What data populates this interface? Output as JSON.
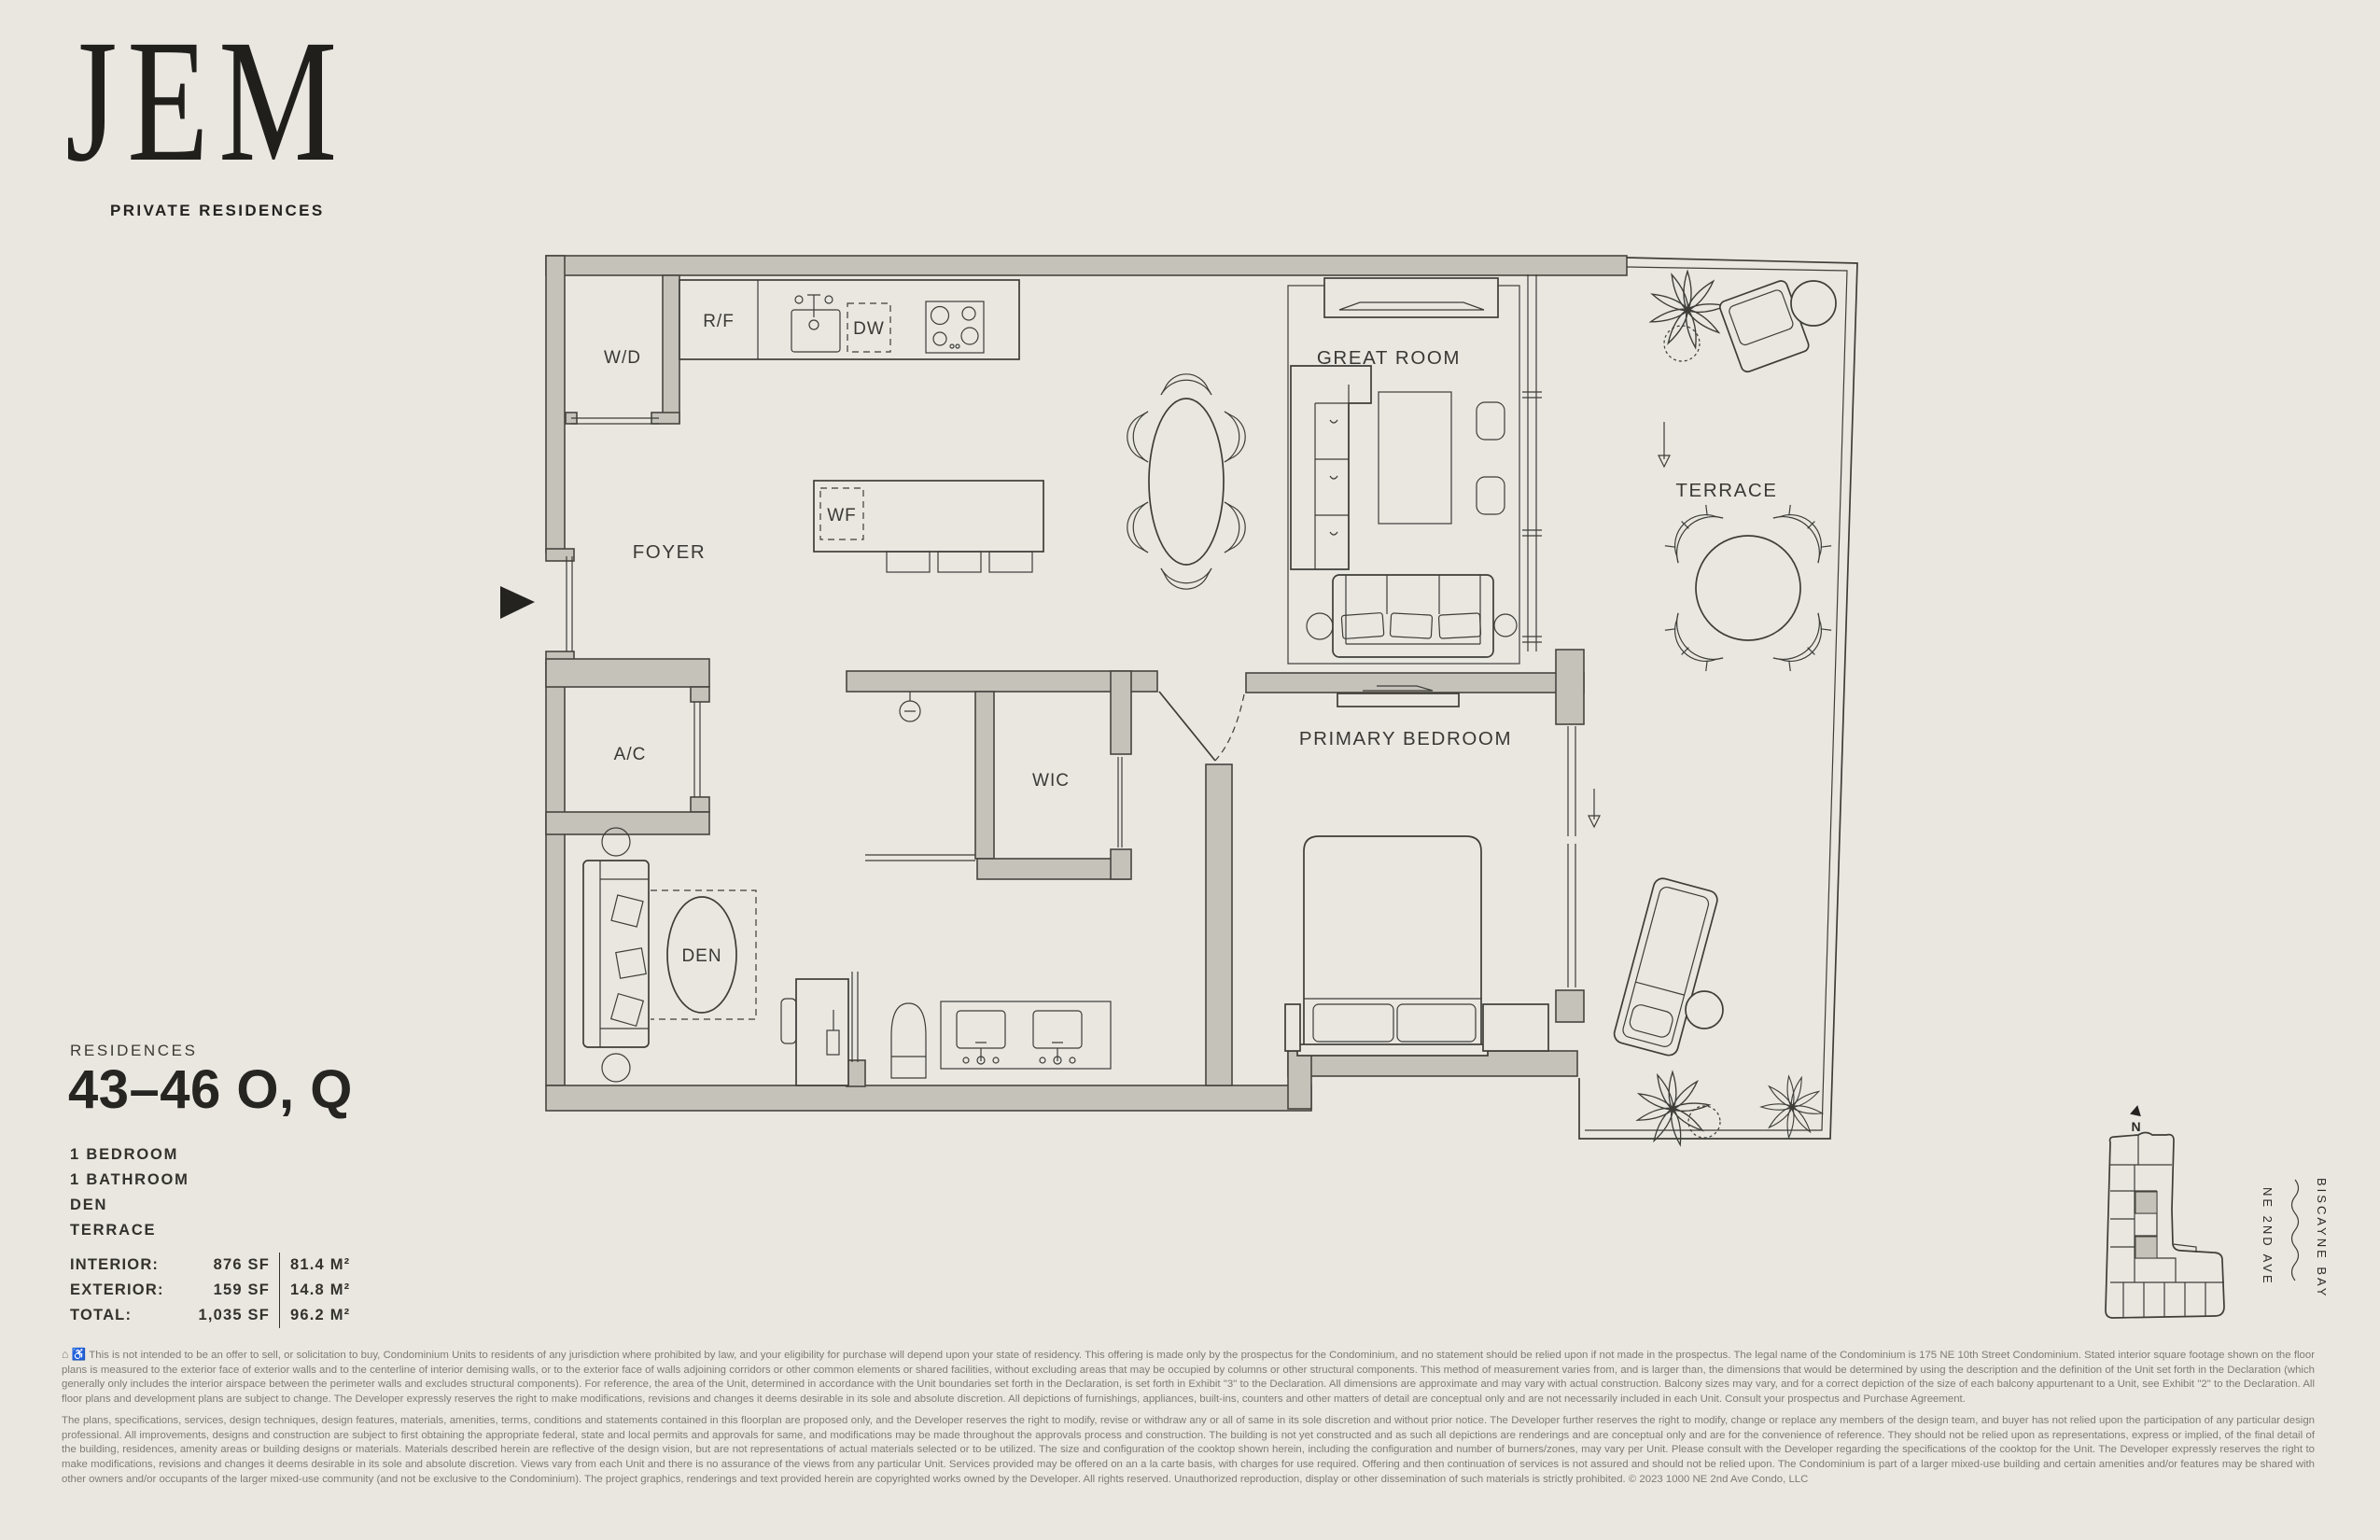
{
  "page": {
    "background": "#eae7e1",
    "wall_gray": "#c5c2ba",
    "line_color": "#3e3d38",
    "ink": "#23221f",
    "muted_text": "#7d7b73"
  },
  "brand": {
    "name": "JEM",
    "tagline": "PRIVATE RESIDENCES"
  },
  "residence": {
    "label": "RESIDENCES",
    "number": "43–46 O, Q",
    "features": [
      "1 BEDROOM",
      "1 BATHROOM",
      "DEN",
      "TERRACE"
    ],
    "areas": [
      {
        "label": "INTERIOR:",
        "sf": "876 SF",
        "m2": "81.4 M²"
      },
      {
        "label": "EXTERIOR:",
        "sf": "159 SF",
        "m2": "14.8 M²"
      },
      {
        "label": "TOTAL:",
        "sf": "1,035 SF",
        "m2": "96.2 M²"
      }
    ]
  },
  "floorplan": {
    "labels": {
      "wd": "W/D",
      "rf": "R/F",
      "dw": "DW",
      "wf": "WF",
      "foyer": "FOYER",
      "great_room": "GREAT ROOM",
      "terrace": "TERRACE",
      "ac": "A/C",
      "wic": "WIC",
      "den": "DEN",
      "primary_bedroom": "PRIMARY BEDROOM"
    }
  },
  "keyplan": {
    "compass": "N",
    "street": "NE 2ND AVE",
    "water": "BISCAYNE BAY"
  },
  "disclaimer": {
    "icons": {
      "equal_housing": "⌂",
      "accessibility": "♿"
    },
    "p1": "This is not intended to be an offer to sell, or solicitation to buy, Condominium Units to residents of any jurisdiction where prohibited by law, and your eligibility for purchase will depend upon your state of residency. This offering is made only by the prospectus for the Condominium, and no statement should be relied upon if not made in the prospectus. The legal name of the Condominium is 175 NE 10th Street Condominium. Stated interior square footage shown on the floor plans is measured to the exterior face of exterior walls and to the centerline of interior demising walls, or to the exterior face of walls adjoining corridors or other common elements or shared facilities, without excluding areas that may be occupied by columns or other structural components. This method of measurement varies from, and is larger than, the dimensions that would be determined by using the description and the definition of the Unit set forth in the Declaration (which generally only includes the interior airspace between the perimeter walls and excludes structural components). For reference, the area of the Unit, determined in accordance with the Unit boundaries set forth in the Declaration, is set forth in Exhibit \"3\" to the Declaration. All dimensions are approximate and may vary with actual construction. Balcony sizes may vary, and for a correct depiction of the size of each balcony appurtenant to a Unit, see Exhibit \"2\" to the Declaration. All floor plans and development plans are subject to change. The Developer expressly reserves the right to make modifications, revisions and changes it deems desirable in its sole and absolute discretion. All depictions of furnishings, appliances, built-ins, counters and other matters of detail are conceptual only and are not necessarily included in each Unit. Consult your prospectus and Purchase Agreement.",
    "p2": "The plans, specifications, services, design techniques, design features, materials, amenities, terms, conditions and statements contained in this floorplan are proposed only, and the Developer reserves the right to modify, revise or withdraw any or all of same in its sole discretion and without prior notice. The Developer further reserves the right to modify, change or replace any members of the design team, and buyer has not relied upon the participation of any particular design professional. All improvements, designs and construction are subject to first obtaining the appropriate federal, state and local permits and approvals for same, and modifications may be made throughout the approvals process and construction. The building is not yet constructed and as such all depictions are renderings and are conceptual only and are for the convenience of reference. They should not be relied upon as representations, express or implied, of the final detail of the building, residences, amenity areas or building designs or materials. Materials described herein are reflective of the design vision, but are not representations of actual materials selected or to be utilized. The size and configuration of the cooktop shown herein, including the configuration and number of burners/zones, may vary per Unit. Please consult with the Developer regarding the specifications of the cooktop for the Unit. The Developer expressly reserves the right to make modifications, revisions and changes it deems desirable in its sole and absolute discretion. Views vary from each Unit and there is no assurance of the views from any particular Unit. Services provided may be offered on an a la carte basis, with charges for use required. Offering and then continuation of services is not assured and should not be relied upon. The Condominium is part of a larger mixed-use building and certain amenities and/or features may be shared with other owners and/or occupants of the larger mixed-use community (and not be exclusive to the Condominium). The project graphics, renderings and text provided herein are copyrighted works owned by the Developer. All rights reserved. Unauthorized reproduction, display or other dissemination of such materials is strictly prohibited. © 2023 1000 NE 2nd Ave Condo, LLC"
  }
}
